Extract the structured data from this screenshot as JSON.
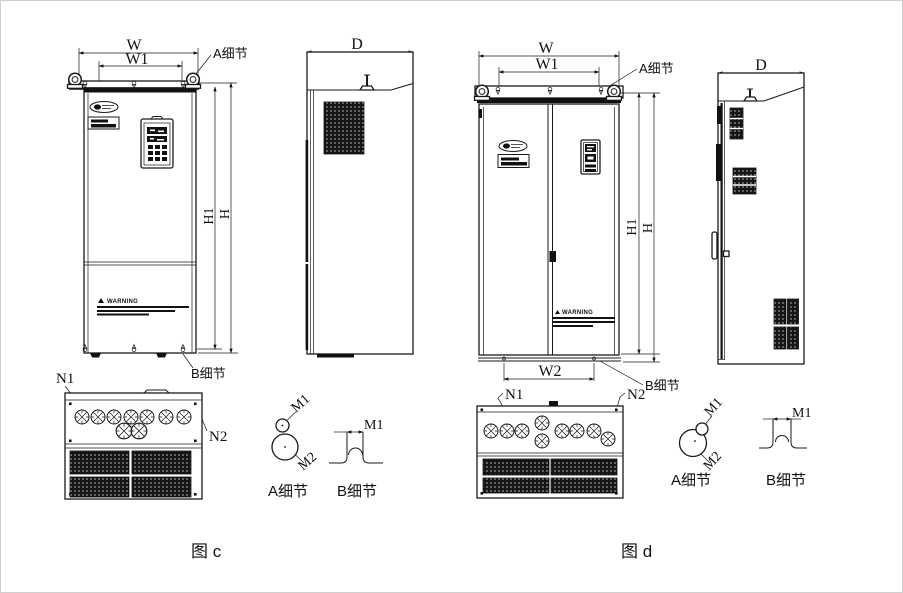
{
  "fig_c": {
    "caption": "图 c",
    "front": {
      "dim_w": "W",
      "dim_w1": "W1",
      "dim_h": "H",
      "dim_h1": "H1",
      "detail_a_callout": "A细节",
      "detail_b_callout": "B细节",
      "warning_title": "WARNING"
    },
    "side": {
      "dim_d": "D"
    },
    "bottom": {
      "n1": "N1",
      "n2": "N2"
    },
    "detail_a": {
      "title": "A细节",
      "m1": "M1",
      "m2": "M2"
    },
    "detail_b": {
      "title": "B细节",
      "m1": "M1"
    }
  },
  "fig_d": {
    "caption": "图 d",
    "front": {
      "dim_w": "W",
      "dim_w1": "W1",
      "dim_w2": "W2",
      "dim_h": "H",
      "dim_h1": "H1",
      "detail_a_callout": "A细节",
      "detail_b_callout": "B细节",
      "warning_title": "WARNING"
    },
    "side": {
      "dim_d": "D"
    },
    "bottom": {
      "n1": "N1",
      "n2": "N2"
    },
    "detail_a": {
      "title": "A细节",
      "m1": "M1",
      "m2": "M2"
    },
    "detail_b": {
      "title": "B细节",
      "m1": "M1"
    }
  }
}
